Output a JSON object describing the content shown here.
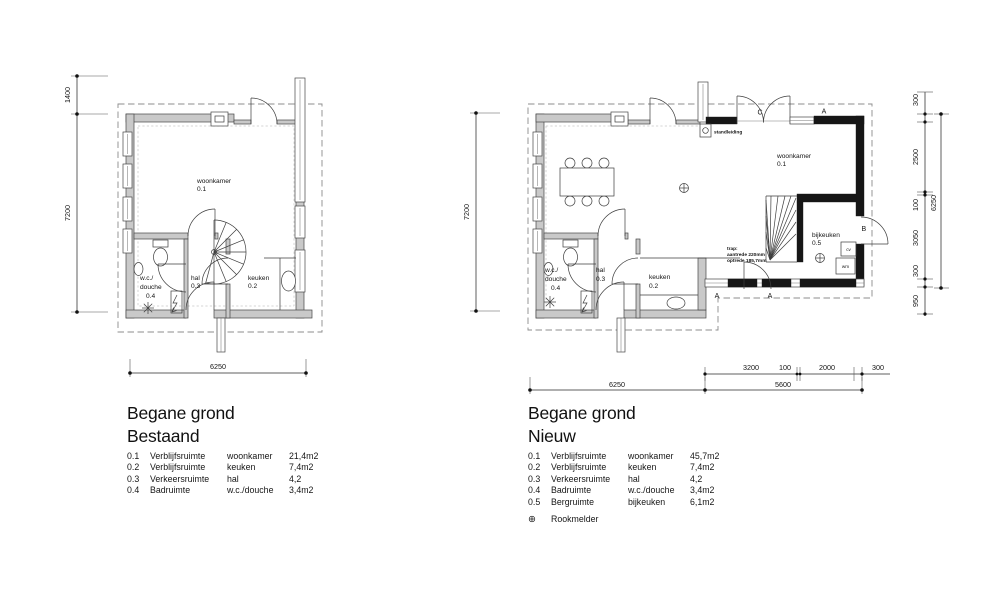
{
  "drawing": {
    "background": "#ffffff",
    "ink": "#1f1f1f",
    "wall_gray": "#c9c9c9",
    "new_wall_black": "#161616"
  },
  "left_plan": {
    "title_line1": "Begane grond",
    "title_line2": "Bestaand",
    "rooms": {
      "woonkamer": {
        "name": "woonkamer",
        "num": "0.1"
      },
      "keuken": {
        "name": "keuken",
        "num": "0.2"
      },
      "hal": {
        "name": "hal",
        "num": "0.3"
      },
      "wc": {
        "name_line1": "w.c./",
        "name_line2": "douche",
        "num": "0.4"
      }
    },
    "dims": {
      "side_upper": "1400",
      "side_main": "7200",
      "bottom_total": "6250"
    },
    "legend_rows": [
      {
        "num": "0.1",
        "type": "Verblijfsruimte",
        "room": "woonkamer",
        "area": "21,4m2"
      },
      {
        "num": "0.2",
        "type": "Verblijfsruimte",
        "room": "keuken",
        "area": "7,4m2"
      },
      {
        "num": "0.3",
        "type": "Verkeersruimte",
        "room": "hal",
        "area": "4,2"
      },
      {
        "num": "0.4",
        "type": "Badruimte",
        "room": "w.c./douche",
        "area": "3,4m2"
      }
    ]
  },
  "right_plan": {
    "title_line1": "Begane grond",
    "title_line2": "Nieuw",
    "rooms": {
      "woonkamer": {
        "name": "woonkamer",
        "num": "0.1"
      },
      "keuken": {
        "name": "keuken",
        "num": "0.2"
      },
      "hal": {
        "name": "hal",
        "num": "0.3"
      },
      "wc": {
        "name_line1": "w.c./",
        "name_line2": "douche",
        "num": "0.4"
      },
      "bijkeuken": {
        "name": "bijkeuken",
        "num": "0.5"
      }
    },
    "annotations": {
      "standleiding": "standleiding",
      "trap_line1": "trap:",
      "trap_line2": "aantrede 220mm",
      "trap_line3": "optrede 185,7mm",
      "cv": "cv",
      "wm": "wm"
    },
    "section_labels": {
      "a": "A",
      "b": "B",
      "c": "C"
    },
    "dims": {
      "side_main": "7200",
      "right_segments": [
        "300",
        "2500",
        "100",
        "3050",
        "300",
        "950"
      ],
      "right_total": "6250",
      "bottom_segments": [
        "3200",
        "100",
        "2000",
        "300"
      ],
      "bottom_total_existing": "6250",
      "bottom_total_new": "5600"
    },
    "legend_rows": [
      {
        "num": "0.1",
        "type": "Verblijfsruimte",
        "room": "woonkamer",
        "area": "45,7m2"
      },
      {
        "num": "0.2",
        "type": "Verblijfsruimte",
        "room": "keuken",
        "area": "7,4m2"
      },
      {
        "num": "0.3",
        "type": "Verkeersruimte",
        "room": "hal",
        "area": "4,2"
      },
      {
        "num": "0.4",
        "type": "Badruimte",
        "room": "w.c./douche",
        "area": "3,4m2"
      },
      {
        "num": "0.5",
        "type": "Bergruimte",
        "room": "bijkeuken",
        "area": "6,1m2"
      }
    ],
    "legend_extra": {
      "symbol": "⊕",
      "label": "Rookmelder"
    }
  }
}
